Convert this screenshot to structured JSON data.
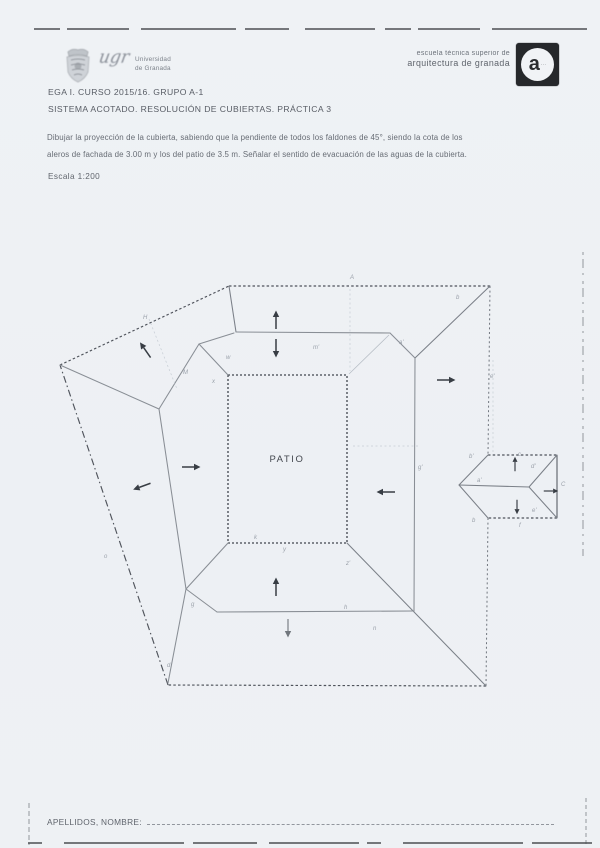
{
  "header": {
    "ugr": {
      "script": "ugr",
      "line1": "Universidad",
      "line2": "de Granada"
    },
    "etsag": {
      "line1": "escuela técnica superior de",
      "line2": "arquitectura de granada",
      "logo_letter": "a",
      "logo_marks": "···"
    }
  },
  "body": {
    "course_line": "EGA I. CURSO 2015/16. GRUPO A-1",
    "practice_line": "SISTEMA ACOTADO. RESOLUCIÓN DE CUBIERTAS. PRÁCTICA 3",
    "statement_line1": "Dibujar la proyección de la cubierta, sabiendo que la pendiente de todos los faldones de 45°, siendo la cota de los",
    "statement_line2": "aleros de fachada de 3.00 m y los del patio de 3.5 m. Señalar el sentido de evacuación de las aguas de la cubierta.",
    "scale_label": "Escala 1:200"
  },
  "drawing": {
    "patio_label": "PATIO",
    "labels": [
      {
        "text": "A",
        "x": 350,
        "y": 279
      },
      {
        "text": "H",
        "x": 143,
        "y": 319
      },
      {
        "text": "M",
        "x": 183,
        "y": 374
      },
      {
        "text": "m'",
        "x": 313,
        "y": 349
      },
      {
        "text": "a'",
        "x": 399,
        "y": 344
      },
      {
        "text": "b",
        "x": 456,
        "y": 299
      },
      {
        "text": "e'",
        "x": 490,
        "y": 378
      },
      {
        "text": "g'",
        "x": 418,
        "y": 469
      },
      {
        "text": "b'",
        "x": 469,
        "y": 458
      },
      {
        "text": "c",
        "x": 518,
        "y": 456
      },
      {
        "text": "d'",
        "x": 531,
        "y": 468
      },
      {
        "text": "C",
        "x": 561,
        "y": 486
      },
      {
        "text": "a'",
        "x": 477,
        "y": 482
      },
      {
        "text": "e'",
        "x": 532,
        "y": 512
      },
      {
        "text": "f",
        "x": 519,
        "y": 527
      },
      {
        "text": "b",
        "x": 472,
        "y": 522
      },
      {
        "text": "z'",
        "x": 346,
        "y": 565
      },
      {
        "text": "h",
        "x": 344,
        "y": 609
      },
      {
        "text": "n",
        "x": 373,
        "y": 630
      },
      {
        "text": "k",
        "x": 254,
        "y": 539
      },
      {
        "text": "y",
        "x": 283,
        "y": 551
      },
      {
        "text": "x",
        "x": 212,
        "y": 383
      },
      {
        "text": "w",
        "x": 226,
        "y": 359
      },
      {
        "text": "o",
        "x": 104,
        "y": 558
      },
      {
        "text": "g",
        "x": 191,
        "y": 606
      },
      {
        "text": "d",
        "x": 167,
        "y": 667
      }
    ],
    "arrows": [
      {
        "x": 276,
        "y": 321,
        "angle": -90
      },
      {
        "x": 276,
        "y": 347,
        "angle": 90
      },
      {
        "x": 146,
        "y": 351,
        "angle": -125
      },
      {
        "x": 190,
        "y": 467,
        "angle": 0
      },
      {
        "x": 143,
        "y": 486,
        "angle": 160
      },
      {
        "x": 387,
        "y": 492,
        "angle": 180
      },
      {
        "x": 445,
        "y": 380,
        "angle": 0
      },
      {
        "x": 276,
        "y": 588,
        "angle": -90
      },
      {
        "x": 288,
        "y": 627,
        "angle": 90,
        "light": true
      },
      {
        "x": 515,
        "y": 465,
        "angle": -90,
        "s": 0.78
      },
      {
        "x": 517,
        "y": 506,
        "angle": 90,
        "s": 0.78
      },
      {
        "x": 550,
        "y": 491,
        "angle": 0,
        "s": 0.78
      }
    ]
  },
  "footer": {
    "label": "APELLIDOS, NOMBRE:"
  }
}
